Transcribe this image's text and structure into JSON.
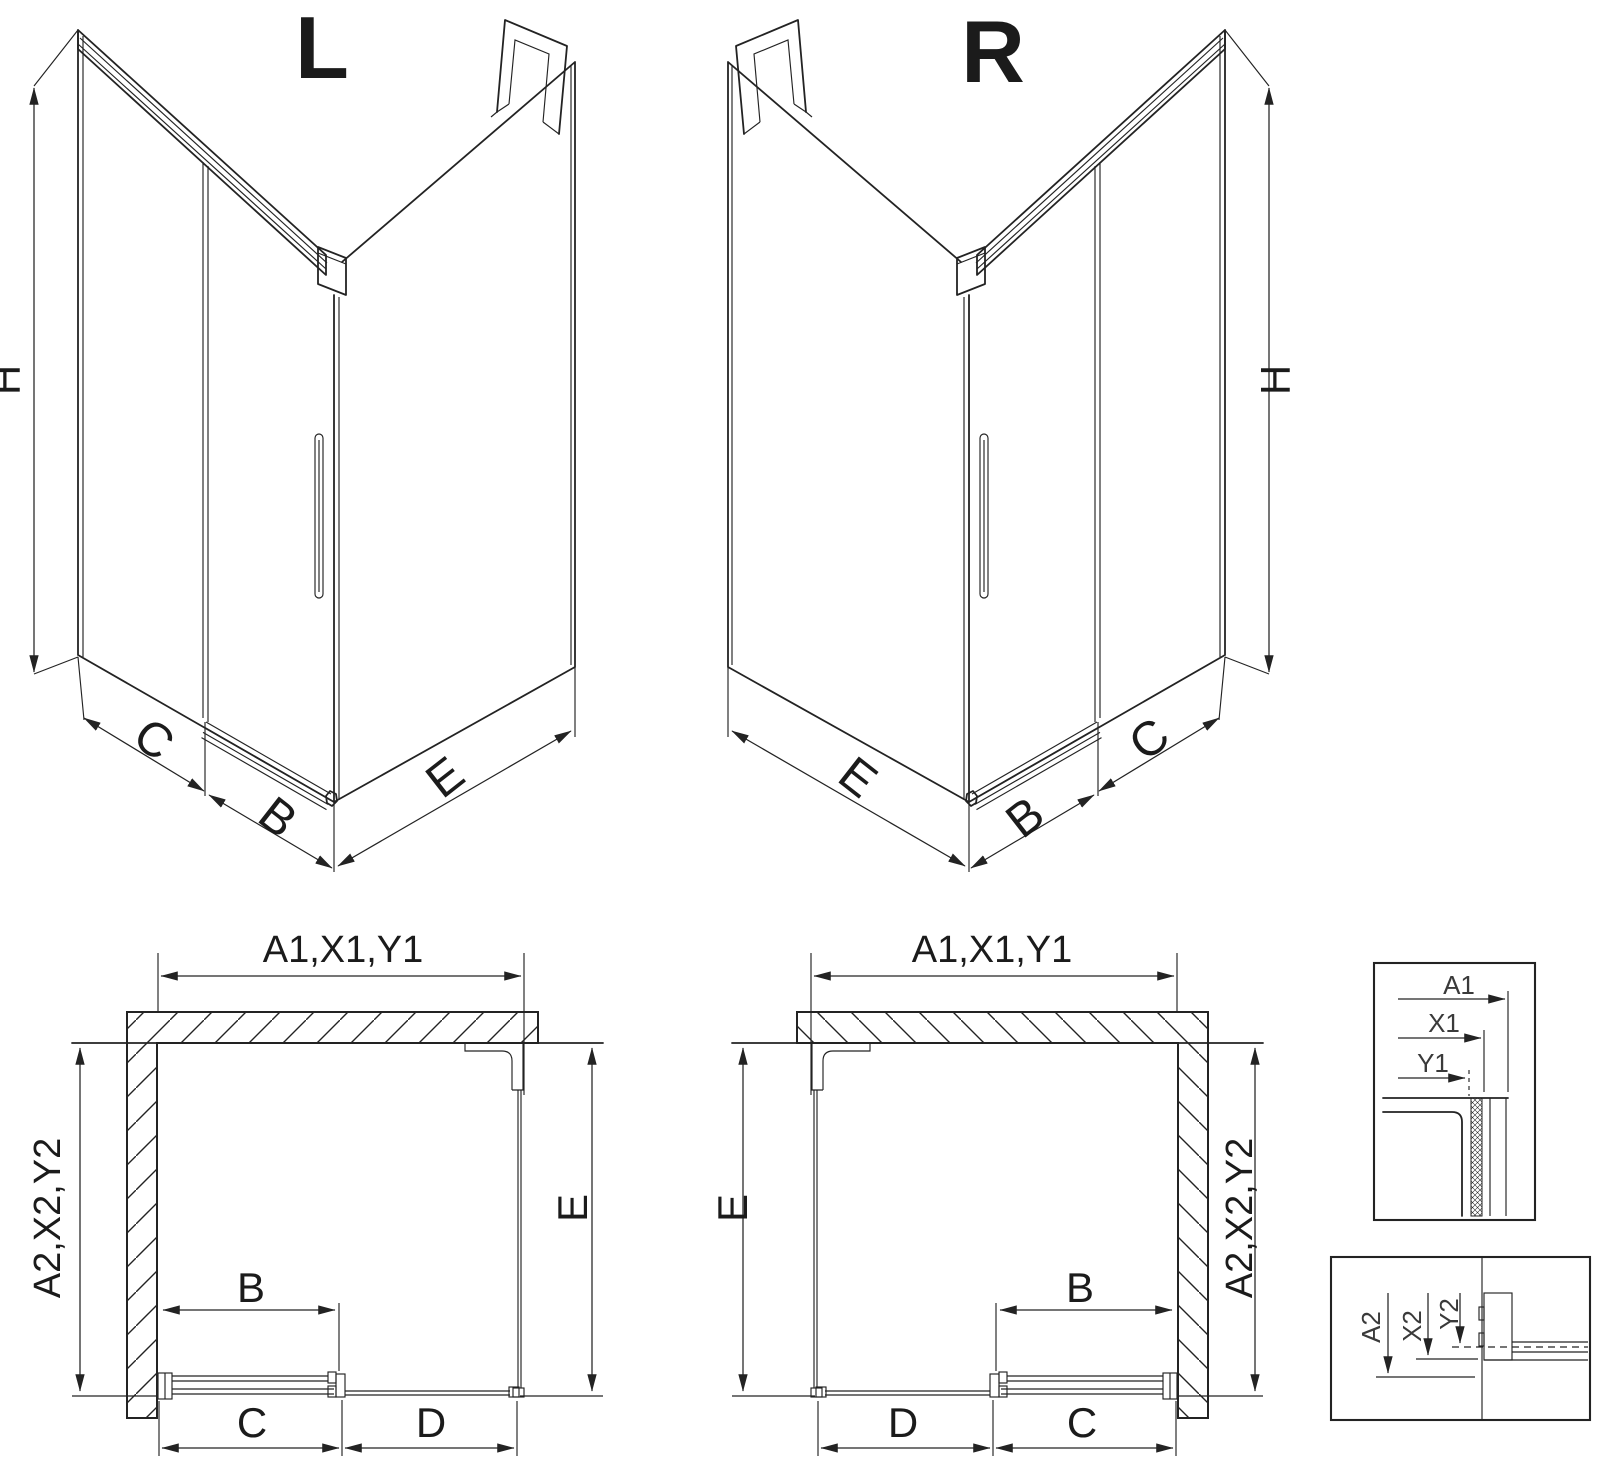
{
  "title": "Corner shower enclosure dimension drawing",
  "colors": {
    "line": "#232323",
    "background": "#ffffff"
  },
  "views": {
    "iso_left": {
      "title": "L",
      "dim_height": "H",
      "dim_wall": "C",
      "dim_door": "B",
      "dim_side": "E"
    },
    "iso_right": {
      "title": "R",
      "dim_height": "H",
      "dim_wall": "C",
      "dim_door": "B",
      "dim_side": "E"
    },
    "plan_left": {
      "dim_top": "A1,X1,Y1",
      "dim_left": "A2,X2,Y2",
      "dim_right": "E",
      "dim_door": "B",
      "dim_bottom_inner": "C",
      "dim_bottom_outer": "D"
    },
    "plan_right": {
      "dim_top": "A1,X1,Y1",
      "dim_left": "E",
      "dim_right": "A2,X2,Y2",
      "dim_door": "B",
      "dim_bottom_inner": "C",
      "dim_bottom_outer": "D"
    },
    "detail_top": {
      "dim_a": "A1",
      "dim_x": "X1",
      "dim_y": "Y1"
    },
    "detail_bottom": {
      "dim_a": "A2",
      "dim_x": "X2",
      "dim_y": "Y2"
    }
  }
}
